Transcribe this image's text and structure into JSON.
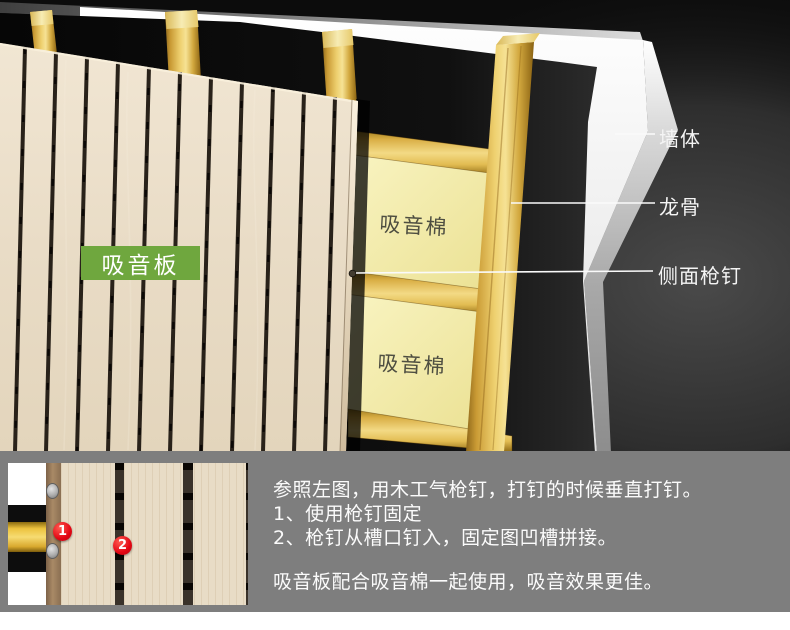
{
  "diagram": {
    "board_label": "吸音板",
    "cotton_label_1": "吸音棉",
    "cotton_label_2": "吸音棉",
    "callouts": {
      "wall": "墙体",
      "keel": "龙骨",
      "side_nail": "侧面枪钉"
    }
  },
  "instructions": {
    "line1": "参照左图，用木工气枪钉，打钉的时候垂直打钉。",
    "line2": "1、使用枪钉固定",
    "line3": "2、枪钉从槽口钉入，固定图凹槽拼接。",
    "note": "吸音板配合吸音棉一起使用，吸音效果更佳。",
    "badge1": "1",
    "badge2": "2"
  },
  "colors": {
    "board_label_green": "#6fa73e",
    "step_badge_red": "#e30613",
    "cotton_yellow": "#f5efb5",
    "keel_gold": "#e3bc59",
    "instruction_panel_gray": "#7e7e7e",
    "wood_light": "#e9dcc6",
    "wall_white": "#f2f2f2",
    "background_black": "#0c0c0c"
  }
}
